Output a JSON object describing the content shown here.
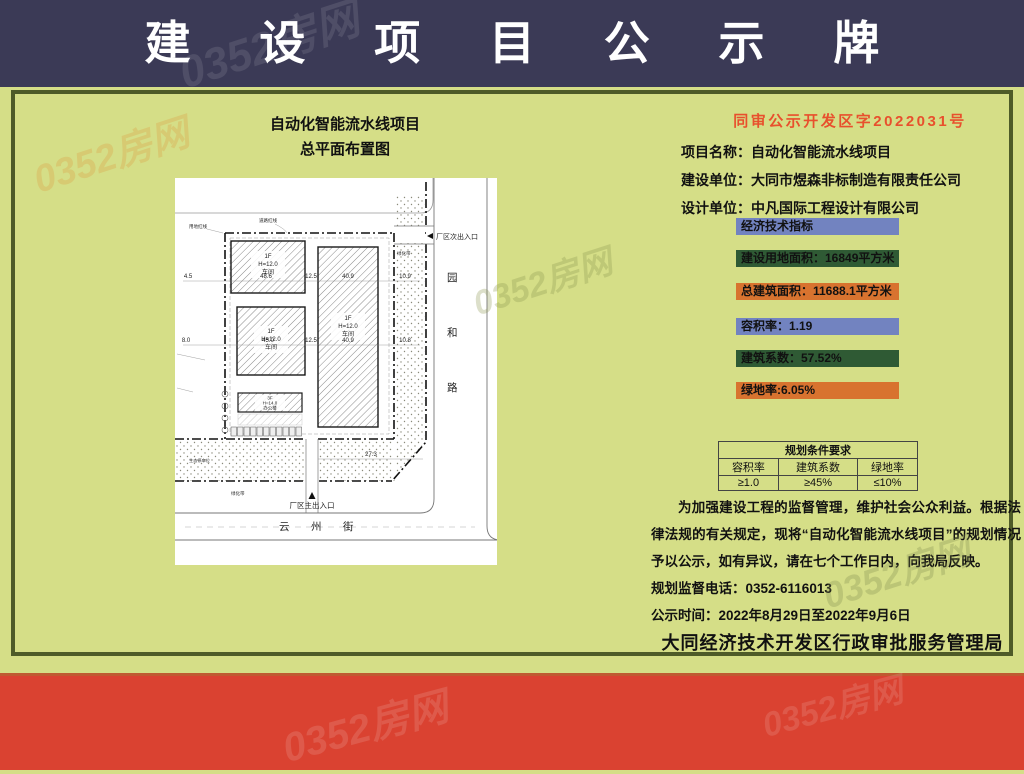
{
  "watermark": {
    "text": "0352房网"
  },
  "header": {
    "title": "建设项目公示牌"
  },
  "doc_no": "同审公示开发区字2022031号",
  "plan": {
    "title_line1": "自动化智能流水线项目",
    "title_line2": "总平面布置图",
    "buildings": [
      {
        "floors": "1F",
        "height": "H=12.0",
        "name": "车间"
      },
      {
        "floors": "1F",
        "height": "H=12.0",
        "name": "车间"
      },
      {
        "floors": "1F",
        "height": "H=12.0",
        "name": "车间"
      },
      {
        "floors": "3F",
        "height": "H=14.0",
        "name": "办公楼"
      }
    ],
    "labels": {
      "side_entrance": "厂区次出入口",
      "main_entrance": "厂区主出入口",
      "land_red_line": "用地红线",
      "road_red_line": "道路红线",
      "green_belt": "绿化带",
      "eco_parking": "生态停车位"
    },
    "roads": {
      "right": [
        "园",
        "和",
        "路"
      ],
      "bottom": [
        "云",
        "州",
        "街"
      ]
    },
    "dims": {
      "d1": "4.5",
      "d2": "48.6",
      "d3": "12.5",
      "d4": "40.9",
      "d5": "10.9",
      "d6": "8.0",
      "d7": "45.0",
      "d8": "12.5",
      "d9": "40.9",
      "d10": "10.8",
      "d11": "27.3"
    }
  },
  "info": {
    "rows": [
      {
        "label": "项目名称：",
        "value": "自动化智能流水线项目"
      },
      {
        "label": "建设单位：",
        "value": "大同市煜森非标制造有限责任公司"
      },
      {
        "label": "设计单位：",
        "value": "中凡国际工程设计有限公司"
      }
    ]
  },
  "indicators": [
    {
      "text": "经济技术指标",
      "color": "#7283c0"
    },
    {
      "text": "建设用地面积：16849平方米",
      "color": "#2f5a34"
    },
    {
      "text": "总建筑面积：11688.1平方米",
      "color": "#d8732f"
    },
    {
      "text": "容积率：1.19",
      "color": "#7283c0"
    },
    {
      "text": "建筑系数：57.52%",
      "color": "#2f5a34"
    },
    {
      "text": "绿地率:6.05%",
      "color": "#d8732f"
    }
  ],
  "req_table": {
    "title": "规划条件要求",
    "headers": [
      "容积率",
      "建筑系数",
      "绿地率"
    ],
    "values": [
      "≥1.0",
      "≥45%",
      "≤10%"
    ]
  },
  "notice": {
    "paragraph": "为加强建设工程的监督管理，维护社会公众利益。根据法律法规的有关规定，现将“自动化智能流水线项目”的规划情况予以公示，如有异议，请在七个工作日内，向我局反映。",
    "phone_line": "规划监督电话：0352-6116013",
    "period_line": "公示时间：2022年8月29日至2022年9月6日"
  },
  "footer": {
    "authority": "大同经济技术开发区行政审批服务管理局"
  },
  "colors": {
    "header_bg": "#3b3a56",
    "page_bg": "#d5de87",
    "panel_border": "#4e5b28",
    "bottom_stripe": "#da4231",
    "doc_no_text": "#e8502d"
  }
}
